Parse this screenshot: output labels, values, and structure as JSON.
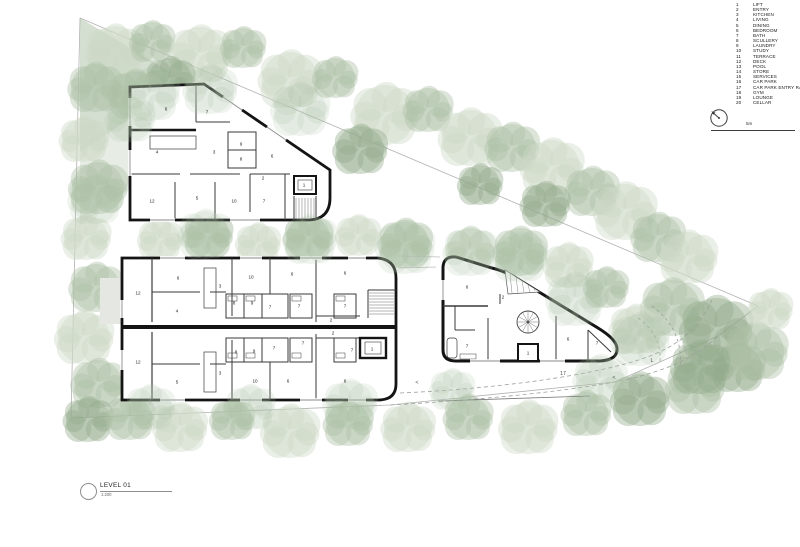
{
  "palette": {
    "tree-light": "#ccd8c6",
    "tree-mid": "#aec2a8",
    "tree-dark": "#93ab8d",
    "wall": "#141414",
    "partition": "#3a3a3a",
    "thin-line": "#8a8a8a",
    "boundary": "#b2b2b2",
    "road": "#9aa09a"
  },
  "legend": {
    "items": [
      {
        "num": "1",
        "label": "LIFT"
      },
      {
        "num": "2",
        "label": "ENTRY"
      },
      {
        "num": "3",
        "label": "KITCHEN"
      },
      {
        "num": "4",
        "label": "LIVING"
      },
      {
        "num": "5",
        "label": "DINING"
      },
      {
        "num": "6",
        "label": "BEDROOM"
      },
      {
        "num": "7",
        "label": "BATH"
      },
      {
        "num": "8",
        "label": "SCULLERY"
      },
      {
        "num": "9",
        "label": "LAUNDRY"
      },
      {
        "num": "10",
        "label": "STUDY"
      },
      {
        "num": "11",
        "label": "TERRACE"
      },
      {
        "num": "12",
        "label": "DECK"
      },
      {
        "num": "13",
        "label": "POOL"
      },
      {
        "num": "14",
        "label": "STORE"
      },
      {
        "num": "15",
        "label": "SERVICES"
      },
      {
        "num": "16",
        "label": "CAR PARK"
      },
      {
        "num": "17",
        "label": "CAR PARK ENTRY RAMP"
      },
      {
        "num": "18",
        "label": "GYM"
      },
      {
        "num": "19",
        "label": "LOUNGE"
      },
      {
        "num": "20",
        "label": "CELLAR"
      }
    ]
  },
  "scale_bar": {
    "label": "5m"
  },
  "title_block": {
    "name": "LEVEL 01",
    "scale": "1:200"
  },
  "plan": {
    "rooms": [
      {
        "t": "6",
        "x": 166,
        "y": 109
      },
      {
        "t": "7",
        "x": 207,
        "y": 112
      },
      {
        "t": "4",
        "x": 157,
        "y": 152
      },
      {
        "t": "3",
        "x": 214,
        "y": 152
      },
      {
        "t": "9",
        "x": 241,
        "y": 144
      },
      {
        "t": "8",
        "x": 241,
        "y": 159
      },
      {
        "t": "6",
        "x": 272,
        "y": 156
      },
      {
        "t": "2",
        "x": 263,
        "y": 178
      },
      {
        "t": "1",
        "x": 304,
        "y": 185
      },
      {
        "t": "12",
        "x": 152,
        "y": 201
      },
      {
        "t": "5",
        "x": 197,
        "y": 198
      },
      {
        "t": "10",
        "x": 234,
        "y": 201
      },
      {
        "t": "7",
        "x": 264,
        "y": 201
      },
      {
        "t": "12",
        "x": 138,
        "y": 293
      },
      {
        "t": "6",
        "x": 178,
        "y": 278
      },
      {
        "t": "4",
        "x": 177,
        "y": 311
      },
      {
        "t": "3",
        "x": 220,
        "y": 286
      },
      {
        "t": "10",
        "x": 251,
        "y": 277
      },
      {
        "t": "6",
        "x": 292,
        "y": 274
      },
      {
        "t": "6",
        "x": 345,
        "y": 273
      },
      {
        "t": "8",
        "x": 234,
        "y": 303
      },
      {
        "t": "9",
        "x": 252,
        "y": 303
      },
      {
        "t": "7",
        "x": 270,
        "y": 307
      },
      {
        "t": "7",
        "x": 299,
        "y": 306
      },
      {
        "t": "7",
        "x": 345,
        "y": 306
      },
      {
        "t": "2",
        "x": 331,
        "y": 320
      },
      {
        "t": "2",
        "x": 333,
        "y": 333
      },
      {
        "t": "12",
        "x": 138,
        "y": 362
      },
      {
        "t": "5",
        "x": 177,
        "y": 382
      },
      {
        "t": "3",
        "x": 220,
        "y": 373
      },
      {
        "t": "10",
        "x": 255,
        "y": 381
      },
      {
        "t": "6",
        "x": 288,
        "y": 381
      },
      {
        "t": "6",
        "x": 345,
        "y": 381
      },
      {
        "t": "8",
        "x": 236,
        "y": 352
      },
      {
        "t": "9",
        "x": 254,
        "y": 351
      },
      {
        "t": "7",
        "x": 274,
        "y": 348
      },
      {
        "t": "7",
        "x": 303,
        "y": 343
      },
      {
        "t": "7",
        "x": 352,
        "y": 350
      },
      {
        "t": "1",
        "x": 372,
        "y": 349
      },
      {
        "t": "6",
        "x": 467,
        "y": 287
      },
      {
        "t": "2",
        "x": 503,
        "y": 297
      },
      {
        "t": "7",
        "x": 467,
        "y": 346
      },
      {
        "t": "1",
        "x": 528,
        "y": 353
      },
      {
        "t": "6",
        "x": 568,
        "y": 339
      },
      {
        "t": "7",
        "x": 597,
        "y": 343
      }
    ],
    "road_marks": [
      {
        "t": "17",
        "x": 563,
        "y": 374
      },
      {
        "t": "<",
        "x": 417,
        "y": 383
      },
      {
        "t": "<",
        "x": 614,
        "y": 378
      },
      {
        "t": "L",
        "x": 652,
        "y": 361
      }
    ]
  }
}
